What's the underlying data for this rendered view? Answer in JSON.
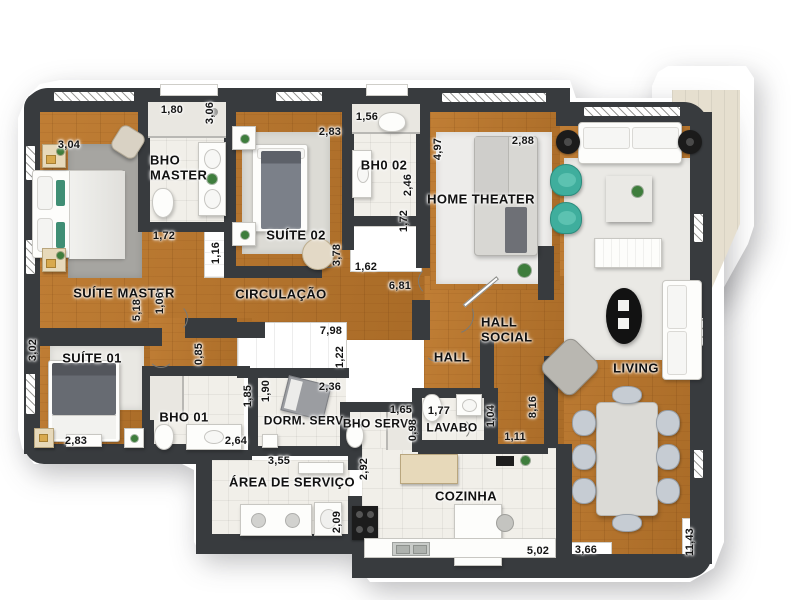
{
  "colors": {
    "wall": "#383b3e",
    "wood": "#b5762e",
    "tile": "#f1efe9",
    "teal_chair": "#3fae9d",
    "rug_master": "#a6a5a1",
    "balcony": "#e6dfcf"
  },
  "rooms": {
    "suite_master": "SUÍTE MASTER",
    "bho_master": "BHO MASTER",
    "suite_02": "SUÍTE 02",
    "bh0_02": "BH0 02",
    "home_theater": "HOME THEATER",
    "circulacao": "CIRCULAÇÃO",
    "hall_social": "HALL SOCIAL",
    "hall": "HALL",
    "living": "LIVING",
    "suite_01": "SUÍTE 01",
    "bho_01": "BHO 01",
    "dorm_serv": "DORM. SERV.",
    "bho_serv": "BHO SERV.",
    "lavabo": "LAVABO",
    "area_servico": "ÁREA DE SERVIÇO",
    "cozinha": "COZINHA"
  },
  "dims": {
    "suite_master_top": "3,04",
    "bho_master_top": "1,80",
    "bho_master_side": "3,06",
    "suite02_top": "2,83",
    "bh02_top": "1,56",
    "home_theater_top": "2,88",
    "home_theater_side": "4,97",
    "bho_master_bottom": "1,72",
    "bh02_side": "2,46",
    "bh02_side2": "1,72",
    "closet_116": "1,16",
    "suite02_bottom": "3,78",
    "bh02_closet": "1,62",
    "circulacao": "6,81",
    "suite_master_side": "5,18",
    "suite_master_side2": "1,06",
    "suite01_side": "3,02",
    "closet_798": "7,98",
    "closet_122": "1,22",
    "hall_085": "0,85",
    "dorm_serv_top": "2,36",
    "dorm_serv_side": "1,90",
    "bho01_side": "1,85",
    "bho_serv_top": "1,65",
    "bho_serv_side": "0,98",
    "lavabo_top": "1,77",
    "lavabo_side": "1,04",
    "hall_side": "8,16",
    "suite01_bottom": "2,83",
    "bho01_bottom": "2,64",
    "area_top": "3,55",
    "area_side": "2,92",
    "area_side2": "2,09",
    "lavabo_bottom": "1,11",
    "cozinha_bottom": "5,02",
    "dining_bottom": "3,66",
    "right_side": "11,43"
  }
}
